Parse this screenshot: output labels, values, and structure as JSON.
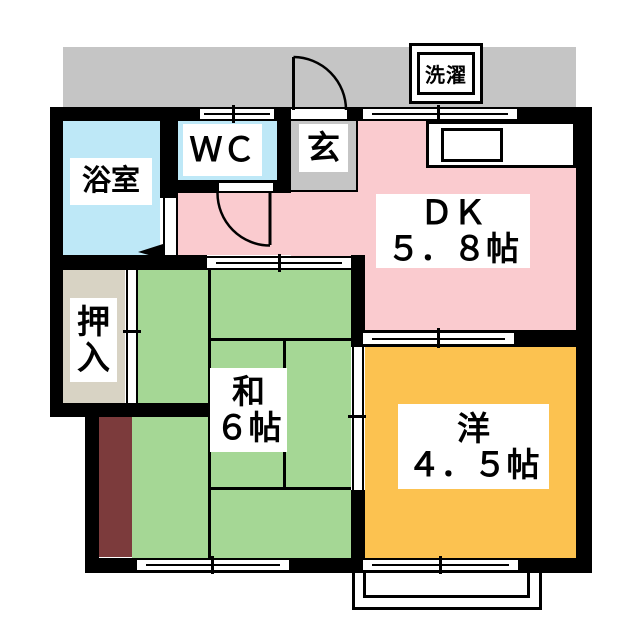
{
  "floorplan": {
    "rooms": {
      "dk": {
        "line1": "ＤＫ",
        "line2": "５．８帖",
        "color": "#facbcf"
      },
      "washitsu": {
        "line1": "和",
        "line2": "６帖",
        "color": "#a5d795"
      },
      "youshitsu": {
        "line1": "洋",
        "line2": "４．５帖",
        "color": "#fcc250"
      },
      "bath": {
        "label": "浴室",
        "color": "#bee8f7"
      },
      "wc": {
        "label": "ＷＣ",
        "color": "#bee8f7"
      },
      "genkan": {
        "label": "玄",
        "color": "#c5c5c5"
      },
      "oshiire": {
        "chars": [
          "押",
          "入"
        ],
        "color": "#d8d3c4"
      }
    },
    "fixtures": {
      "laundry_label": "洗濯"
    },
    "colors": {
      "wall": "#000000",
      "corridor": "#c5c5c5",
      "storage_strip": "#7c3b3c",
      "background": "#ffffff"
    }
  }
}
